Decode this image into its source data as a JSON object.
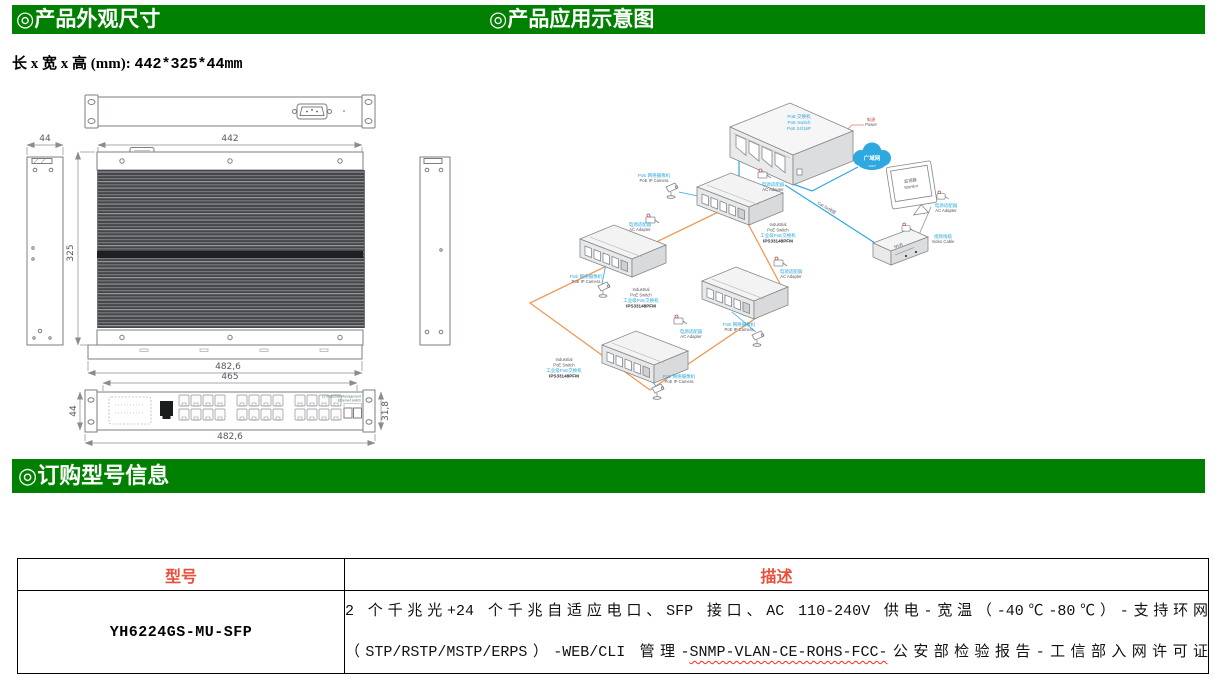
{
  "sections": {
    "appearance_title": "◎产品外观尺寸",
    "application_title": "◎产品应用示意图",
    "ordering_title": "◎订购型号信息"
  },
  "dimensions": {
    "label": "长 x 宽 x 高 (mm): ",
    "value": "442*325*44mm"
  },
  "drawing": {
    "dim_width": "442",
    "dim_depth": "325",
    "dim_side": "44",
    "dim_flange": "482,6",
    "dim_front_width": "465",
    "dim_front_height": "31,8",
    "panel_text_line1": "L2 Industrial Management",
    "panel_text_line2": "Ethernet switch"
  },
  "diagram": {
    "core_switch_label": [
      "PoE 交换机",
      "PoE Switch",
      "PoE 24/16P"
    ],
    "power_label": [
      "电源",
      "Power"
    ],
    "cloud_label": "广域网",
    "cloud_sub_label": "WAN",
    "monitor_label": [
      "监视器",
      "Monitor"
    ],
    "nvr_label": "NVR",
    "video_cable_label": [
      "视频线缆",
      "Video Cable"
    ],
    "cat5e_label": "Cat.5e线缆",
    "ac_adapter_label": [
      "电源适配器",
      "AC Adapter"
    ],
    "camera_label": [
      "PoE 网络摄像机",
      "PoE IP Camera"
    ],
    "industrial_switch_label": [
      "Industrial",
      "PoE Switch",
      "工业级PoE交换机",
      "IPS33148PFM"
    ]
  },
  "order_table": {
    "col_model": "型号",
    "col_desc": "描述",
    "model": "YH6224GS-MU-SFP",
    "desc_line1": "2 个千兆光+24 个千兆自适应电口、SFP 接口、AC 110-240V 供电-宽温（-40℃-80℃）-支持环网",
    "desc_line2_pre": "（STP/RSTP/MSTP/ERPS）-WEB/CLI 管理-",
    "desc_line2_wavy": "SNMP-VLAN-CE-ROHS-FCC-",
    "desc_line2_post": "公安部检验报告-工信部入网许可证"
  },
  "colors": {
    "header_green": "#008000",
    "table_header_red": "#E8503C",
    "diagram_blue": "#2EA8E0",
    "diagram_orange": "#F09A57",
    "wavy_underline_red": "#FF2A1A"
  }
}
